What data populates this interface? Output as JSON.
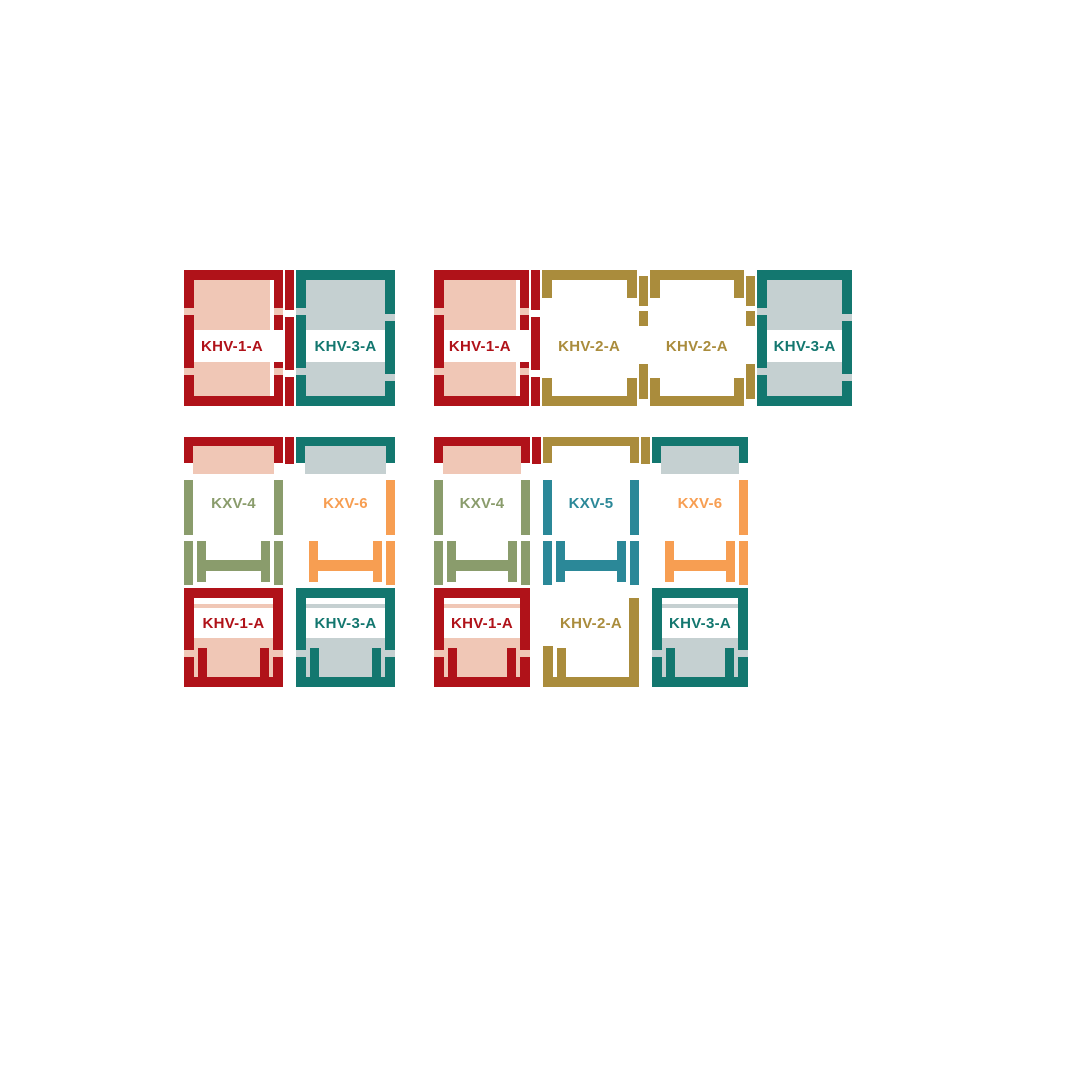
{
  "palette": {
    "background": "#ffffff",
    "khv1_red": "#b01219",
    "khv1_fill_pink": "#f0c7b6",
    "khv2_gold": "#aa8c3c",
    "khv2_fill_white": "#ffffff",
    "khv3_teal": "#13776f",
    "khv3_fill_gray": "#c5d0d1",
    "kxv4_olive": "#8a9c6c",
    "kxv5_blue": "#2b8898",
    "kxv6_orange": "#f79e52",
    "label_band_white": "#ffffff"
  },
  "diagrams": {
    "top_left": {
      "layout": "1 row x 2 windows",
      "units": [
        {
          "label": "KHV-1-A",
          "color": "#b01219",
          "fill": "#f0c7b6"
        },
        {
          "label": "KHV-3-A",
          "color": "#13776f",
          "fill": "#c5d0d1"
        }
      ]
    },
    "top_right": {
      "layout": "1 row x 4 windows",
      "units": [
        {
          "label": "KHV-1-A",
          "color": "#b01219",
          "fill": "#f0c7b6"
        },
        {
          "label": "KHV-2-A",
          "color": "#aa8c3c",
          "fill": "#ffffff"
        },
        {
          "label": "KHV-2-A",
          "color": "#aa8c3c",
          "fill": "#ffffff"
        },
        {
          "label": "KHV-3-A",
          "color": "#13776f",
          "fill": "#c5d0d1"
        }
      ]
    },
    "bottom_left": {
      "layout": "2 rows x 2 windows",
      "columns": [
        {
          "upper": {
            "label": "KXV-4",
            "color": "#8a9c6c"
          },
          "lower": {
            "label": "KHV-1-A",
            "color": "#b01219",
            "fill": "#f0c7b6"
          }
        },
        {
          "upper": {
            "label": "KXV-6",
            "color": "#f79e52"
          },
          "lower": {
            "label": "KHV-3-A",
            "color": "#13776f",
            "fill": "#c5d0d1"
          }
        }
      ]
    },
    "bottom_right": {
      "layout": "2 rows x 3 windows",
      "columns": [
        {
          "upper": {
            "label": "KXV-4",
            "color": "#8a9c6c"
          },
          "lower": {
            "label": "KHV-1-A",
            "color": "#b01219",
            "fill": "#f0c7b6"
          }
        },
        {
          "upper": {
            "label": "KXV-5",
            "color": "#2b8898"
          },
          "lower": {
            "label": "KHV-2-A",
            "color": "#aa8c3c",
            "fill": "#ffffff"
          }
        },
        {
          "upper": {
            "label": "KXV-6",
            "color": "#f79e52"
          },
          "lower": {
            "label": "KHV-3-A",
            "color": "#13776f",
            "fill": "#c5d0d1"
          }
        }
      ]
    }
  }
}
